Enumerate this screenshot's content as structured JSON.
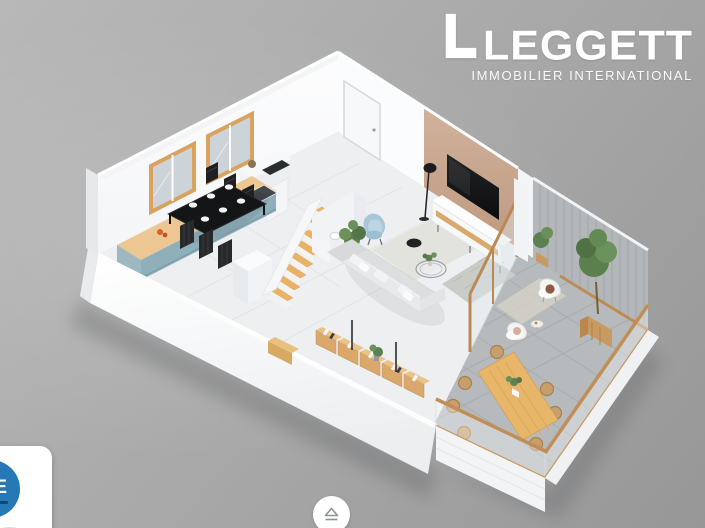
{
  "window": {
    "width": 705,
    "height": 528,
    "kind": "property-listing-3d-floorplan-photo"
  },
  "branding": {
    "logo_text": "LEGGETT",
    "logo_tagline": "IMMOBILIER INTERNATIONAL",
    "logo_mark": "white-L-bracket"
  },
  "overlays": {
    "badge": {
      "visible_text": "IDE",
      "style": "white-rounded-card-with-blue-circle-and-green-leaf",
      "clipped": "left-bottom-corner"
    },
    "nav_button": {
      "icon": "eject-icon"
    }
  },
  "scene": {
    "type": "isometric-3d-floorplan",
    "rooms": [
      {
        "name": "kitchen-dining",
        "furniture": [
          "teal-kitchen-counter",
          "wood-worktop",
          "cooktop",
          "sink",
          "fruit-bowl",
          "black-dining-table",
          "six-black-chairs",
          "white-place-settings",
          "two-wood-framed-windows",
          "white-cabinet",
          "microwave"
        ]
      },
      {
        "name": "hall-stairs",
        "furniture": [
          "white-entry-door",
          "wood-staircase",
          "wc-toilet",
          "potted-plant",
          "blue-armchair"
        ]
      },
      {
        "name": "living-room",
        "furniture": [
          "beige-tv-wall",
          "flat-screen-tv",
          "tv-console",
          "black-floor-lamp",
          "black-pouf",
          "gray-l-shaped-sofa",
          "white-cushions",
          "light-rug",
          "patterned-rug",
          "round-glass-coffee-table",
          "plant",
          "wood-sideboards-with-books"
        ]
      },
      {
        "name": "terrace",
        "furniture": [
          "gray-tile-floor",
          "wood-dining-table",
          "seven-rattan-chairs",
          "two-white-lounge-chairs",
          "side-table",
          "outdoor-rug",
          "planter-trees",
          "gray-slat-wall",
          "glass-wood-railing",
          "white-deck-skirt"
        ]
      }
    ],
    "palette": {
      "bg-top": "#b8b8b8",
      "bg-bottom": "#979797",
      "wall-white": "#fbfcfd",
      "wall-shade": "#e6e8ea",
      "floor-light": "#edeff1",
      "terrace-tile": "#b6babd",
      "accent-beige": "#c7a28c",
      "slat-gray": "#b4b7b9",
      "counter-teal": "#8fb0ba",
      "wood": "#e0b169",
      "wood-dark": "#bc8c55",
      "sofa-gray": "#dcdee0",
      "armchair-blue": "#a7c6d8",
      "plant-green": "#5d8050",
      "rattan": "#c79f6d",
      "tv-black": "#161617",
      "badge-blue": "#2779b5",
      "badge-green": "#58b14e",
      "logo-white": "#ffffff"
    }
  }
}
